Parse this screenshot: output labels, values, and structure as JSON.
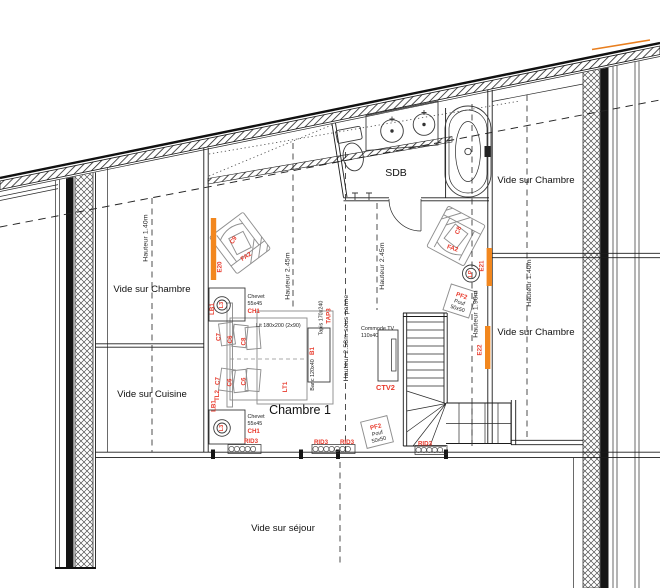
{
  "plan": {
    "rooms": {
      "vide_sur_chambre_left": "Vide sur Chambre",
      "vide_sur_cuisine": "Vide sur Cuisine",
      "vide_sur_sejour": "Vide sur séjour",
      "sdb": "SDB",
      "chambre1": "Chambre 1",
      "vide_sur_chambre_top_right": "Vide sur Chambre",
      "vide_sur_chambre_bottom_right": "Vide sur Chambre"
    },
    "heights": {
      "h_140_left": "Hauteur 1.40m",
      "h_245_bed": "Hauteur 2.45m",
      "h_258_panne": "Hauteur 2.58m sous panne",
      "h_245_hall": "Hauteur 2.45m",
      "h_190": "Hauteur 1.90m",
      "h_140_right": "Hauteur 1.40m"
    },
    "furniture": {
      "bed": {
        "code": "LT1",
        "label": "Lit 180x200 (2x90)"
      },
      "headboard_code": "LB1",
      "wall_light_code": "TL2",
      "bench": {
        "code": "B1",
        "label": "Banc 120x40"
      },
      "rug": {
        "code": "TAP3",
        "label": "Tapis 170x240"
      },
      "nightstand": {
        "code": "CH1",
        "label": "Chevet",
        "size": "55x45"
      },
      "nightstand_lamp_code": "L3",
      "floor_lamp_code": "LP",
      "armchair_code": "FA2",
      "cushion_c6": "C6",
      "cushion_c7": "C7",
      "cushion_c8": "C8",
      "cushion_c9": "C9",
      "pouf": {
        "code": "PF2",
        "label": "Pouf",
        "size": "50x50"
      },
      "tv_unit": {
        "code": "CTV2",
        "label": "Commode TV",
        "size": "110x40"
      },
      "radiator_code": "RID3",
      "electric_heater_e20": "E20",
      "electric_heater_e21": "E21",
      "electric_heater_e22": "E22"
    },
    "colors": {
      "accent_orange": "#F2871E",
      "label_red": "#E8392B",
      "line": "#1B1B1B",
      "furniture_gray": "#8F8F8F"
    }
  }
}
